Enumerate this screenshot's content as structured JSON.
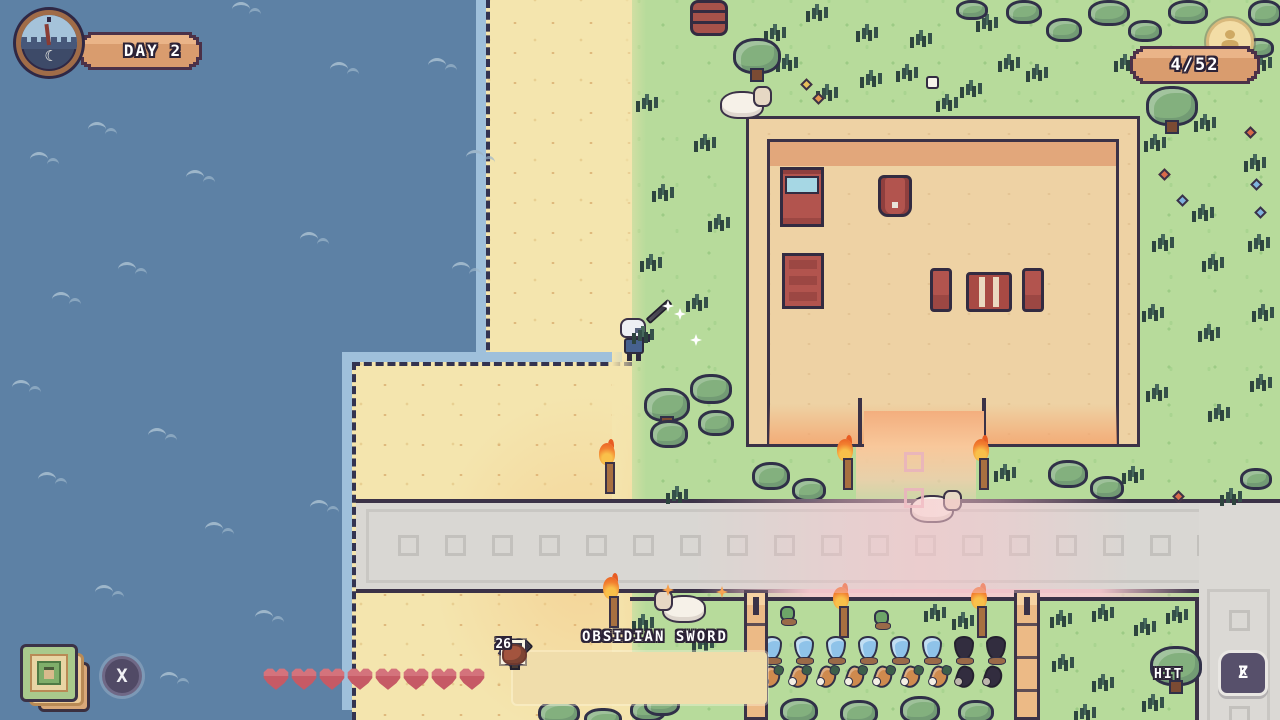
{
  "hud": {
    "day": "DAY 2",
    "counter": "4/52",
    "hint": {
      "text": "HIT",
      "button_z": "Z",
      "button_r": "R"
    },
    "cards_button": "X",
    "clock_moon": "☾",
    "health": {
      "hearts_filled": 8,
      "hearts_total": 8
    },
    "hotbar": {
      "selected_label": "OBSIDIAN SWORD",
      "slots": [
        {
          "icon": "obsidian-sword",
          "selected": true,
          "count": ""
        },
        {
          "icon": "obsidian-pickaxe",
          "selected": false,
          "count": ""
        },
        {
          "icon": "obsidian-axe",
          "selected": false,
          "count": ""
        },
        {
          "icon": "watering-can",
          "selected": false,
          "count": ""
        },
        {
          "icon": "tile-frame",
          "selected": false,
          "count": "27"
        },
        {
          "icon": "clay-chunk",
          "selected": false,
          "count": "6"
        }
      ]
    }
  },
  "palette": {
    "water": "#5d81a5",
    "sand": "#f4e5ae",
    "grass": "#b7db9b",
    "road": "#d9d7d3",
    "path_pink": "#f2cdd2",
    "building_floor": "#eed2a4",
    "building_band": "#e2a77b",
    "outline": "#3b3247",
    "heart_red": "#c65a65",
    "banner_tan": "#d99c6e",
    "flame_orange": "#f28030",
    "crop_blue": "#8fc3e9",
    "furniture_red": "#b2544e"
  },
  "scene": {
    "waves": [
      [
        40,
        8
      ],
      [
        232,
        2
      ],
      [
        88,
        122
      ],
      [
        30,
        152
      ],
      [
        186,
        170
      ],
      [
        330,
        62
      ],
      [
        300,
        232
      ],
      [
        118,
        262
      ],
      [
        52,
        292
      ],
      [
        12,
        380
      ],
      [
        148,
        428
      ],
      [
        38,
        472
      ],
      [
        205,
        522
      ],
      [
        95,
        585
      ],
      [
        255,
        610
      ],
      [
        160,
        672
      ],
      [
        428,
        58
      ],
      [
        466,
        150
      ],
      [
        452,
        262
      ],
      [
        310,
        500
      ]
    ],
    "tufts": [
      [
        642,
        98
      ],
      [
        700,
        138
      ],
      [
        658,
        188
      ],
      [
        714,
        218
      ],
      [
        646,
        258
      ],
      [
        692,
        298
      ],
      [
        638,
        330
      ],
      [
        770,
        28
      ],
      [
        812,
        8
      ],
      [
        782,
        58
      ],
      [
        822,
        88
      ],
      [
        862,
        28
      ],
      [
        866,
        74
      ],
      [
        902,
        68
      ],
      [
        916,
        34
      ],
      [
        942,
        98
      ],
      [
        966,
        84
      ],
      [
        982,
        18
      ],
      [
        1004,
        58
      ],
      [
        1032,
        68
      ],
      [
        1120,
        58
      ],
      [
        1256,
        58
      ],
      [
        1150,
        138
      ],
      [
        1200,
        118
      ],
      [
        1250,
        158
      ],
      [
        1158,
        238
      ],
      [
        1208,
        258
      ],
      [
        1254,
        238
      ],
      [
        1148,
        308
      ],
      [
        1204,
        328
      ],
      [
        1258,
        308
      ],
      [
        1152,
        388
      ],
      [
        1214,
        408
      ],
      [
        1256,
        378
      ],
      [
        1198,
        208
      ],
      [
        672,
        490
      ],
      [
        1000,
        468
      ],
      [
        1128,
        470
      ],
      [
        1226,
        492
      ],
      [
        638,
        618
      ],
      [
        698,
        638
      ],
      [
        658,
        678
      ],
      [
        718,
        662
      ],
      [
        638,
        698
      ],
      [
        930,
        608
      ],
      [
        958,
        616
      ],
      [
        1056,
        614
      ],
      [
        1098,
        608
      ],
      [
        1140,
        622
      ],
      [
        1172,
        610
      ],
      [
        1058,
        658
      ],
      [
        1098,
        678
      ],
      [
        1148,
        698
      ],
      [
        1080,
        708
      ],
      [
        1182,
        658
      ]
    ],
    "trees": [
      [
        733,
        38,
        48,
        36
      ],
      [
        1146,
        86,
        52,
        40
      ],
      [
        644,
        388,
        46,
        34
      ],
      [
        1150,
        646,
        52,
        40
      ]
    ],
    "shrubs": [
      [
        690,
        374,
        42,
        30
      ],
      [
        650,
        420,
        38,
        28
      ],
      [
        698,
        410,
        36,
        26
      ],
      [
        752,
        462,
        38,
        28
      ],
      [
        792,
        478,
        34,
        24
      ],
      [
        1048,
        460,
        40,
        28
      ],
      [
        1090,
        476,
        34,
        24
      ],
      [
        956,
        0,
        32,
        20
      ],
      [
        1006,
        0,
        36,
        24
      ],
      [
        1046,
        18,
        36,
        24
      ],
      [
        1088,
        0,
        42,
        26
      ],
      [
        1128,
        20,
        34,
        22
      ],
      [
        1168,
        0,
        40,
        24
      ],
      [
        1210,
        22,
        34,
        22
      ],
      [
        1248,
        0,
        34,
        26
      ],
      [
        1244,
        38,
        30,
        20
      ],
      [
        538,
        700,
        42,
        26
      ],
      [
        584,
        708,
        38,
        22
      ],
      [
        630,
        698,
        36,
        24
      ],
      [
        644,
        692,
        36,
        24
      ],
      [
        1240,
        468,
        32,
        22
      ],
      [
        780,
        698,
        38,
        26
      ],
      [
        840,
        700,
        38,
        26
      ],
      [
        900,
        696,
        40,
        28
      ],
      [
        958,
        700,
        36,
        24
      ]
    ],
    "flowers": [
      [
        802,
        80,
        "yellow"
      ],
      [
        814,
        94,
        "orange"
      ],
      [
        1160,
        170,
        "red"
      ],
      [
        1178,
        196,
        "blue"
      ],
      [
        1246,
        128,
        "red"
      ],
      [
        1252,
        180,
        "blue"
      ],
      [
        1256,
        208,
        "blue"
      ],
      [
        1174,
        492,
        "red"
      ]
    ],
    "torches": [
      [
        598,
        436
      ],
      [
        836,
        432
      ],
      [
        972,
        432
      ],
      [
        602,
        570
      ],
      [
        832,
        580
      ],
      [
        970,
        580
      ]
    ],
    "sheep": [
      [
        720,
        86,
        "right"
      ],
      [
        910,
        490,
        "right"
      ],
      [
        660,
        590,
        "left"
      ]
    ],
    "sparkles_white": [
      [
        674,
        308
      ],
      [
        690,
        334
      ],
      [
        662,
        300
      ]
    ],
    "sparkles_orange": [
      [
        662,
        584
      ],
      [
        716,
        586
      ],
      [
        698,
        630
      ]
    ],
    "white_item": [
      926,
      76
    ],
    "barrel": [
      690,
      0
    ],
    "posts": [
      [
        744,
        590,
        24,
        130
      ],
      [
        1014,
        590,
        26,
        130
      ]
    ],
    "crops": {
      "saplings": [
        [
          780,
          606
        ],
        [
          874,
          610
        ]
      ],
      "blue": [
        [
          762,
          636
        ],
        [
          794,
          636
        ],
        [
          826,
          636
        ],
        [
          858,
          636
        ],
        [
          890,
          636
        ],
        [
          922,
          636
        ]
      ],
      "dark_blue": [
        [
          954,
          636
        ],
        [
          986,
          636
        ]
      ],
      "carrots": [
        [
          762,
          666
        ],
        [
          790,
          666
        ],
        [
          818,
          666
        ],
        [
          846,
          666
        ],
        [
          874,
          666
        ],
        [
          902,
          666
        ],
        [
          930,
          666
        ]
      ],
      "dark_carrots": [
        [
          956,
          666
        ],
        [
          984,
          666
        ]
      ]
    },
    "furniture": [
      {
        "type": "bed",
        "x": 780,
        "y": 167
      },
      {
        "type": "armchair",
        "x": 878,
        "y": 175
      },
      {
        "type": "dresser",
        "x": 782,
        "y": 253
      },
      {
        "type": "chair",
        "x": 930,
        "y": 268
      },
      {
        "type": "table",
        "x": 966,
        "y": 272
      },
      {
        "type": "chair",
        "x": 1022,
        "y": 268
      }
    ],
    "road": {
      "h_tiles": {
        "x0": 398,
        "y": 36,
        "step": 47,
        "count": 19,
        "size": 21
      },
      "v_tiles": {
        "x": 30,
        "y0": 107,
        "step": 48,
        "count": 3,
        "size": 21
      }
    },
    "path_tiles": [
      [
        904,
        452
      ],
      [
        904,
        488
      ]
    ]
  }
}
